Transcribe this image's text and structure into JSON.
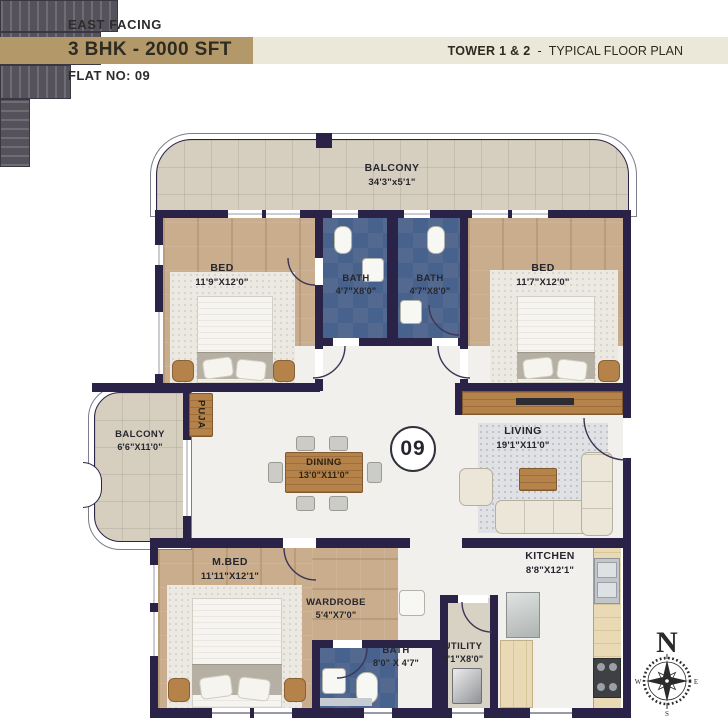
{
  "header": {
    "facing": "EAST FACING",
    "unit_type": "3 BHK - 2000 SFT",
    "tower": "TOWER 1 & 2",
    "separator": "-",
    "plan_type": "TYPICAL FLOOR PLAN",
    "flat_no": "FLAT NO: 09"
  },
  "unit_number": "09",
  "rooms": {
    "balcony_top": {
      "label": "BALCONY",
      "dims": "34'3\"x5'1\""
    },
    "bed1": {
      "label": "BED",
      "dims": "11'9\"X12'0\""
    },
    "bath1": {
      "label": "BATH",
      "dims": "4'7\"X8'0\""
    },
    "bath2": {
      "label": "BATH",
      "dims": "4'7\"X8'0\""
    },
    "bed2": {
      "label": "BED",
      "dims": "11'7\"X12'0\""
    },
    "balcony_left": {
      "label": "BALCONY",
      "dims": "6'6\"X11'0\""
    },
    "puja": {
      "label": "PUJA"
    },
    "dining": {
      "label": "DINING",
      "dims": "13'0\"X11'0\""
    },
    "living": {
      "label": "LIVING",
      "dims": "19'1\"X11'0\""
    },
    "mbed": {
      "label": "M.BED",
      "dims": "11'11\"X12'1\""
    },
    "wardrobe": {
      "label": "WARDROBE",
      "dims": "5'4\"X7'0\""
    },
    "bath3": {
      "label": "BATH",
      "dims": "8'0\" X 4'7\""
    },
    "utility": {
      "label": "UTILITY",
      "dims": "4'1\"X8'0\""
    },
    "kitchen": {
      "label": "KITCHEN",
      "dims": "8'8\"X12'1\""
    }
  },
  "compass": {
    "north": "N",
    "east": "E",
    "south": "S",
    "west": "W"
  },
  "colors": {
    "accent-gold": "#b39969",
    "banner-cream": "#ebe8da",
    "wall": "#2a2347",
    "wood": "#c9ad8c",
    "wood-furniture": "#b5824a",
    "bath-blue": "#4d6793",
    "balcony-beige": "#d6cfc0",
    "marble": "#f1f0ed",
    "closet-dark": "#56525b",
    "text-dark": "#26262e"
  }
}
